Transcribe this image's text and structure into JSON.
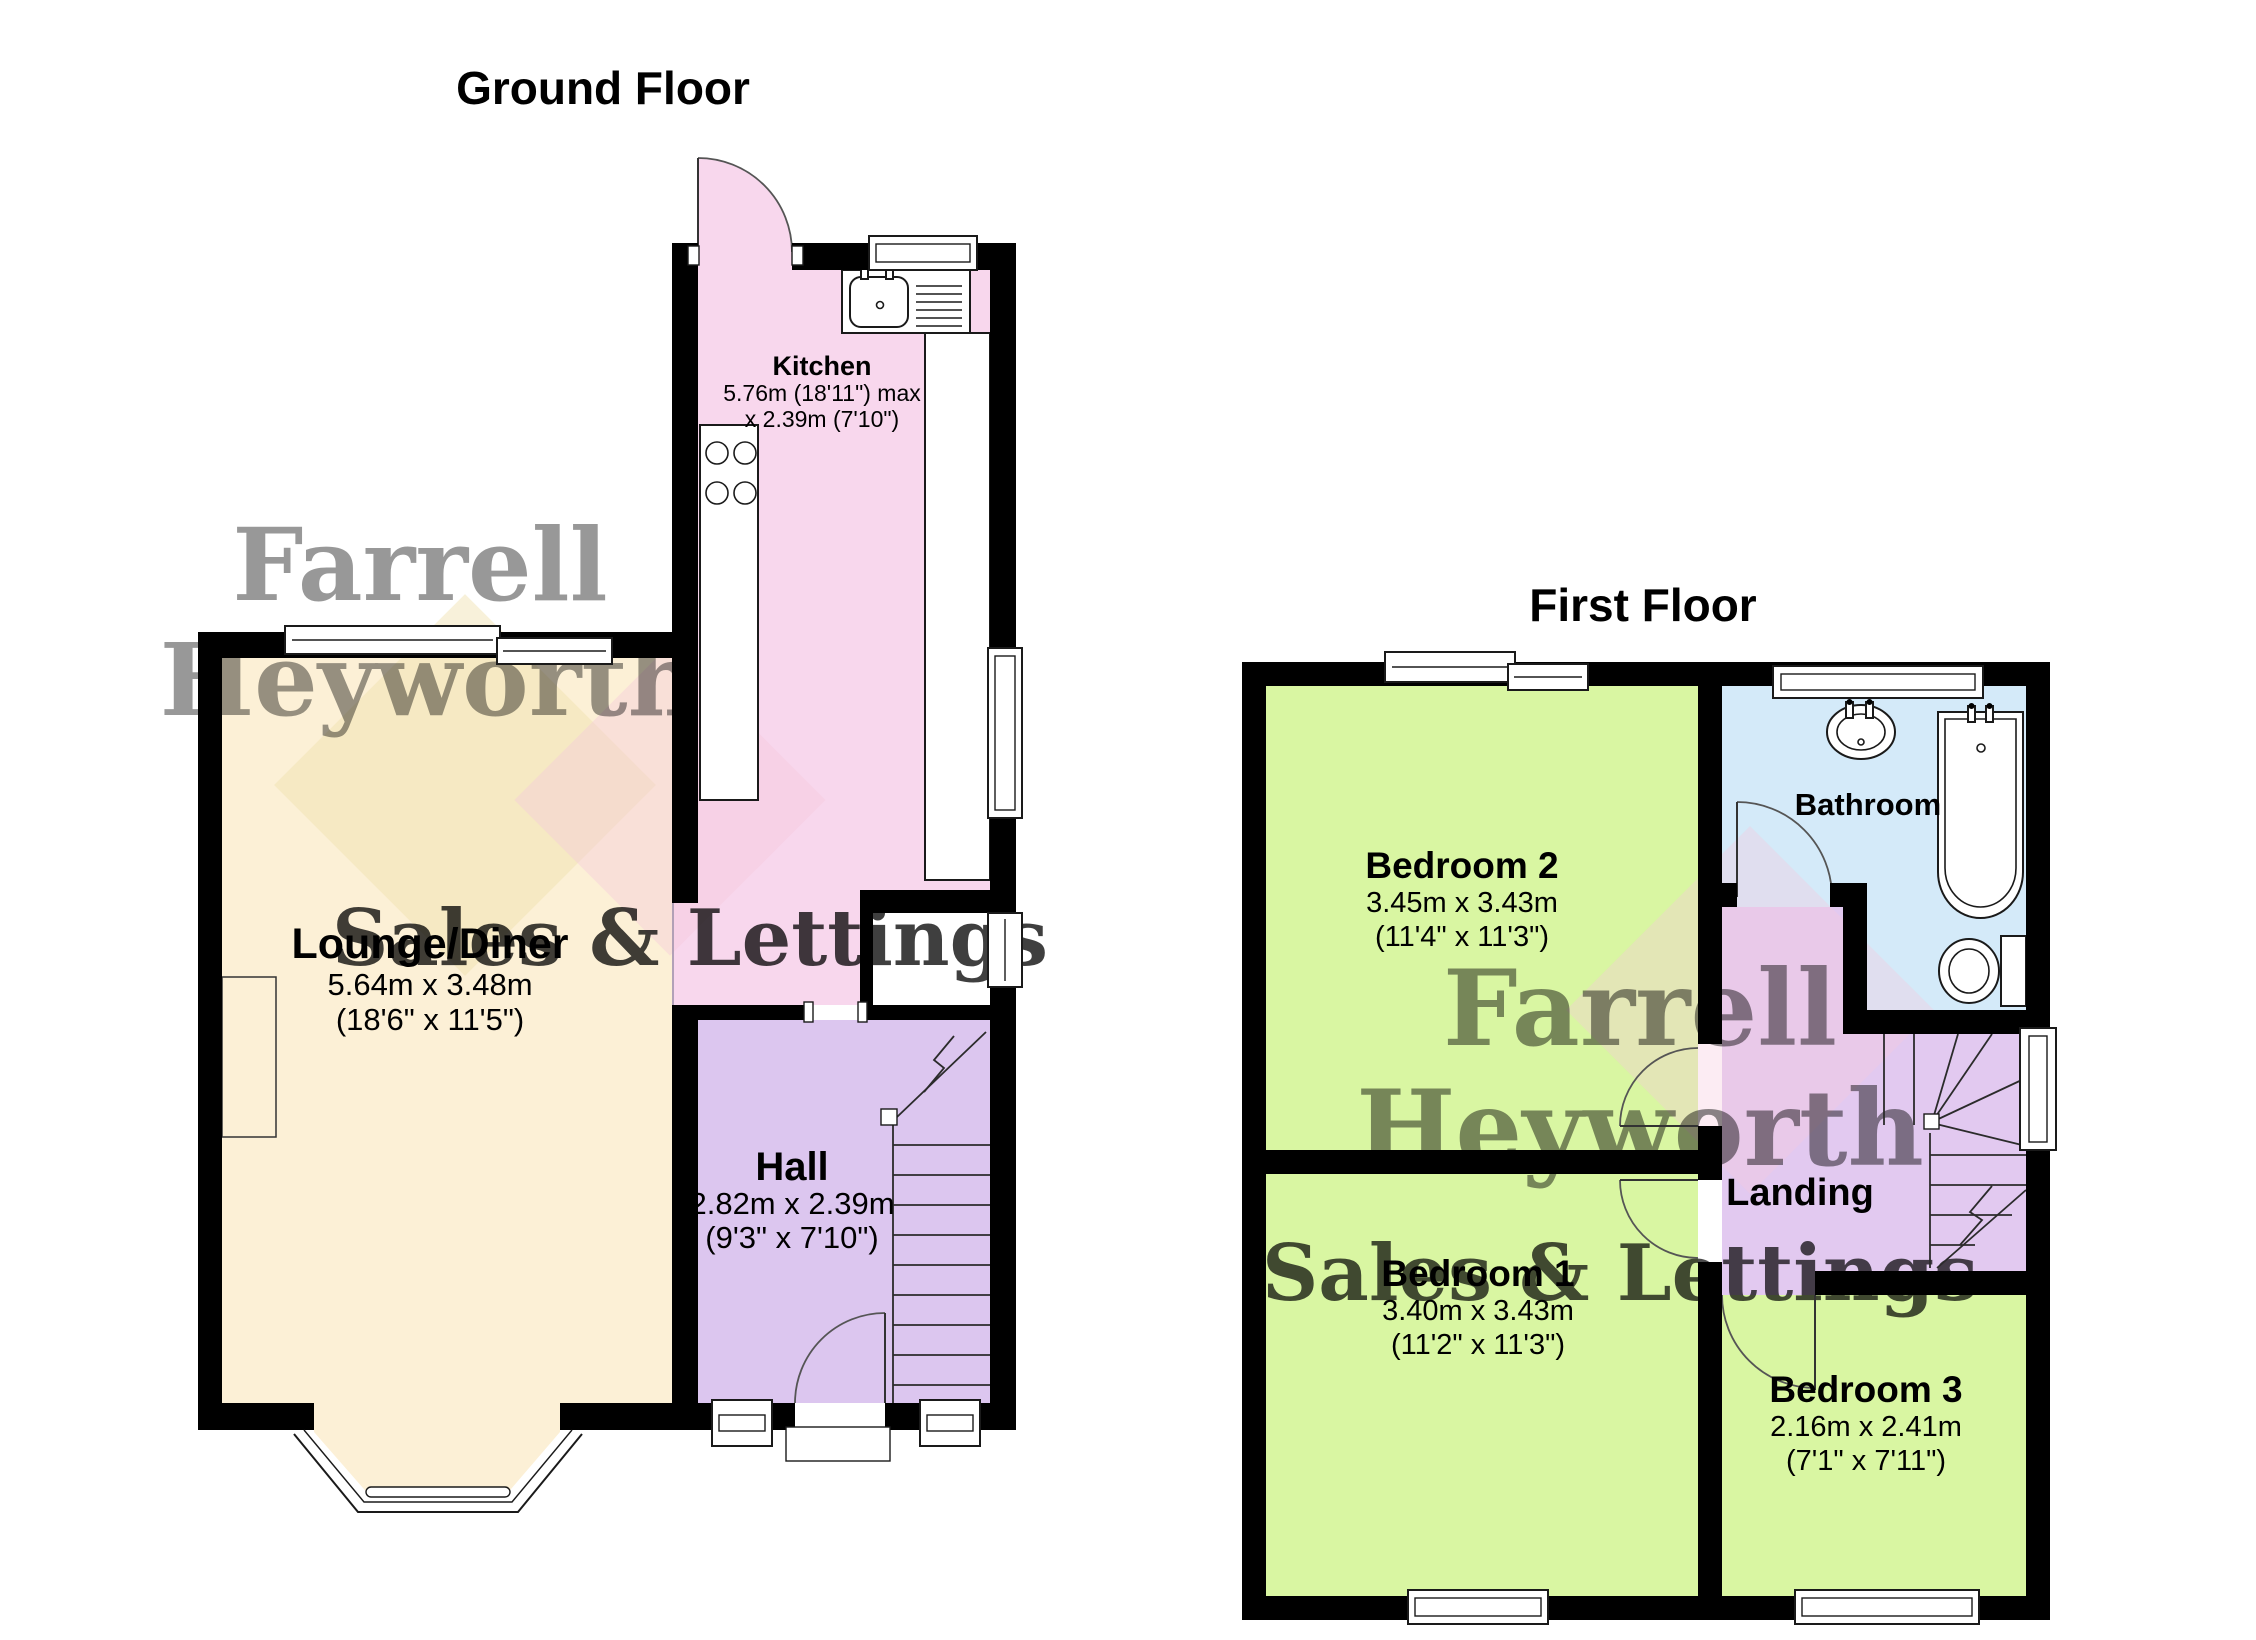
{
  "ground_floor": {
    "title": "Ground Floor",
    "kitchen": {
      "name": "Kitchen",
      "dim_line1": "5.76m (18'11\") max",
      "dim_line2": "x 2.39m (7'10\")"
    },
    "lounge": {
      "name": "Lounge/Diner",
      "dim_line1": "5.64m x 3.48m",
      "dim_line2": "(18'6\" x 11'5\")"
    },
    "hall": {
      "name": "Hall",
      "dim_line1": "2.82m x 2.39m",
      "dim_line2": "(9'3\" x 7'10\")"
    }
  },
  "first_floor": {
    "title": "First Floor",
    "bedroom2": {
      "name": "Bedroom 2",
      "dim_line1": "3.45m x 3.43m",
      "dim_line2": "(11'4\" x 11'3\")"
    },
    "bathroom": {
      "name": "Bathroom"
    },
    "landing": {
      "name": "Landing"
    },
    "bedroom1": {
      "name": "Bedroom 1",
      "dim_line1": "3.40m x 3.43m",
      "dim_line2": "(11'2\" x 11'3\")"
    },
    "bedroom3": {
      "name": "Bedroom 3",
      "dim_line1": "2.16m x 2.41m",
      "dim_line2": "(7'1\" x 7'11\")"
    }
  },
  "watermark": {
    "line1": "Farrell",
    "line2": "Heyworth",
    "line3": "Sales & Lettings"
  },
  "colors": {
    "kitchen": "#f8d7ed",
    "lounge": "#fcf0d6",
    "hall": "#dcc6ef",
    "landing": "#e2c9f0",
    "bedroom": "#d9f6a2",
    "bathroom": "#d4eaf9",
    "wall": "#000000",
    "watermark_gray": "#8f8f89",
    "watermark_pink": "#f3bcd2",
    "watermark_yellow": "#e8d89a"
  }
}
